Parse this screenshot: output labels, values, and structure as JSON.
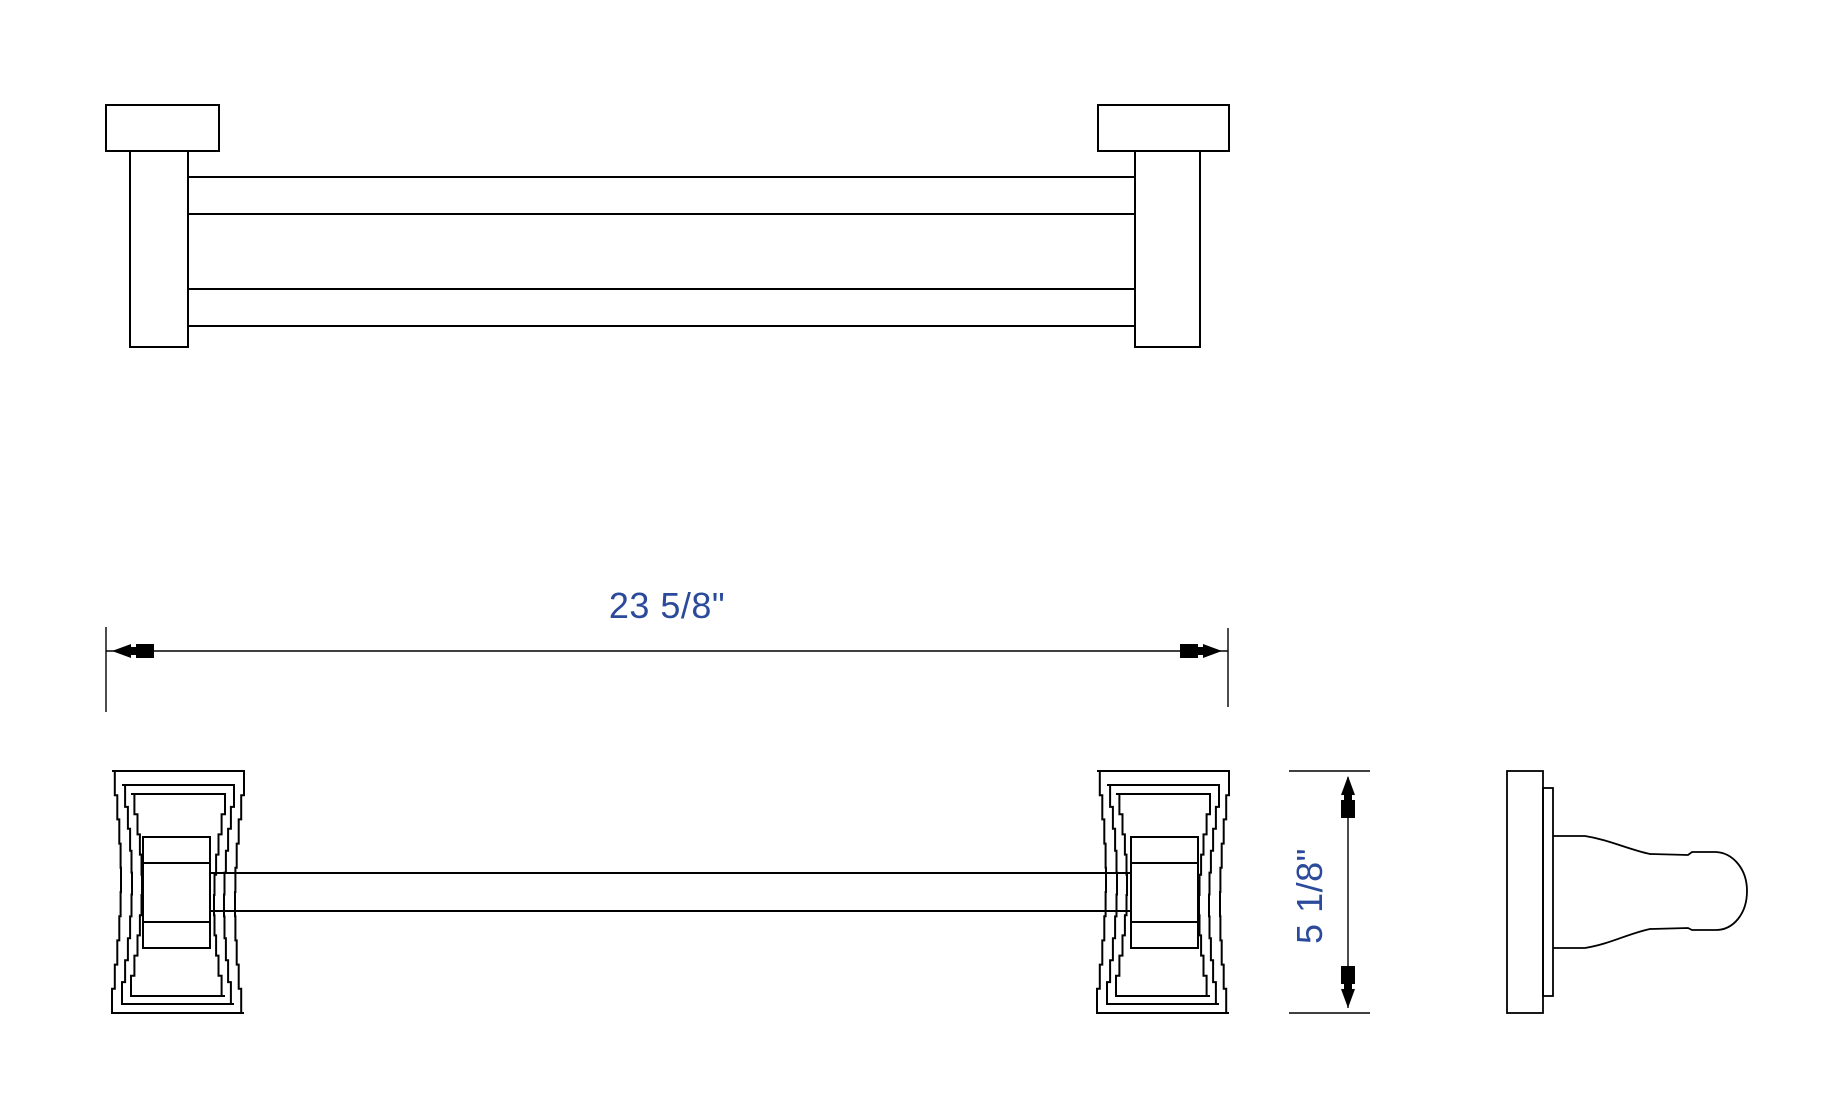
{
  "drawing": {
    "background": "#ffffff",
    "line_color": "#000000",
    "dimension_text_color": "#2b4a9b",
    "width_dimension": {
      "label": "23 5/8\""
    },
    "height_dimension": {
      "label": "5 1/8\""
    }
  }
}
